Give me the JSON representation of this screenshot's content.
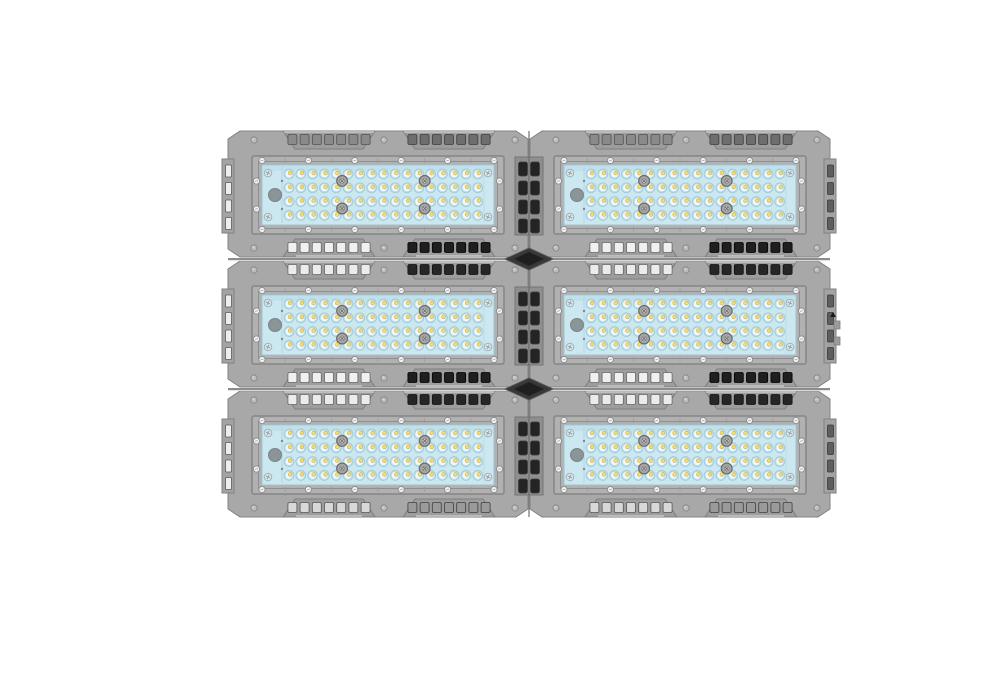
{
  "scene": {
    "title": "Modular LED flood light fixture, top view, six modules in two columns and three rows on a white background",
    "background_color": "#ffffff"
  },
  "fixture": {
    "grid": {
      "columns": 2,
      "rows": 3
    },
    "origin": {
      "x": 227,
      "y": 129
    },
    "cell": {
      "width": 302,
      "height": 130
    },
    "module": {
      "led_rows": 4,
      "led_cols": 17,
      "vent_slots_per_grille": 7,
      "grilles_per_edge": 2,
      "lens_hex_screws": 4,
      "lens_corner_screws": 4,
      "frame_screws_top": 6,
      "frame_screws_bottom": 6,
      "frame_screws_per_side": 2,
      "wing_slots": 4,
      "fin_slot_rows": 4,
      "fin_slot_cols": 2
    },
    "colors": {
      "body": "#a8a8a8",
      "body_edge": "#838383",
      "grille_face": "#9d9d9d",
      "grille_edge": "#7e7e7e",
      "grille_highlight": "#c9c9c9",
      "frame_face": "#b1b1b1",
      "frame_edge": "#868686",
      "frame_inner_line": "#8f8f8f",
      "lens": "#cbe7f0",
      "lens_top_shade": "#c0e0eb",
      "lens_edge": "#9fc4d2",
      "lens_divider": "#b4d6e2",
      "led_ring": "#b7dcea",
      "led_ring_edge": "#a0c7d6",
      "led_well": "#eff8fb",
      "led_chip": "#f3dd72",
      "led_chip_dark": "#d8ad3f",
      "screw_light": "#f3f3f3",
      "screw_ring": "#8f8f8f",
      "bump_screw": "#bcbcbc",
      "bump_screw_edge": "#898989",
      "hex_screw": "#a6a6a6",
      "hex_screw_edge": "#6b6b6b",
      "corner_screw": "#dce6e9",
      "corner_screw_edge": "#9db3bc",
      "gland": "#8b9598",
      "gland_edge": "#788488",
      "wing_slot_light": "#ededed",
      "wing_slot_light_edge": "#5a5a5a",
      "wing_slot_dark": "#5e5e5e",
      "wing_slot_dark_edge": "#3a3a3a",
      "fin_channel": "#8f8f8f",
      "fin_channel_edge": "#757575",
      "fin_slot": "#242424",
      "seam_dark": "#666666",
      "seam_light": "#d8d8d8",
      "center_seam": "#7c7c7c",
      "diamond": "#383838",
      "diamond_core": "#1f1f1f",
      "diamond_edge": "#555555",
      "tab_fill": "#9c9c9c",
      "tab_edge": "#7e7e7e",
      "tab_mark": "#1a1a1a"
    },
    "vent_styles": {
      "top_first_row": {
        "left": {
          "fill": "#8a8a8a",
          "stroke": "#515151"
        },
        "right": {
          "fill": "#6e6e6e",
          "stroke": "#3e3e3e"
        }
      },
      "top_seam": {
        "left": {
          "fill": "#ebebeb",
          "stroke": "#666666"
        },
        "right": {
          "fill": "#262626",
          "stroke": "#111111"
        }
      },
      "bottom_seam": {
        "left": {
          "fill": "#f0f0f0",
          "stroke": "#666666"
        },
        "right": {
          "fill": "#1f1f1f",
          "stroke": "#000000"
        }
      },
      "bottom_last_row": {
        "left": {
          "fill": "#d8d8d8",
          "stroke": "#565656"
        },
        "right": {
          "fill": "#9a9a9a",
          "stroke": "#3f3f3f"
        }
      }
    }
  }
}
